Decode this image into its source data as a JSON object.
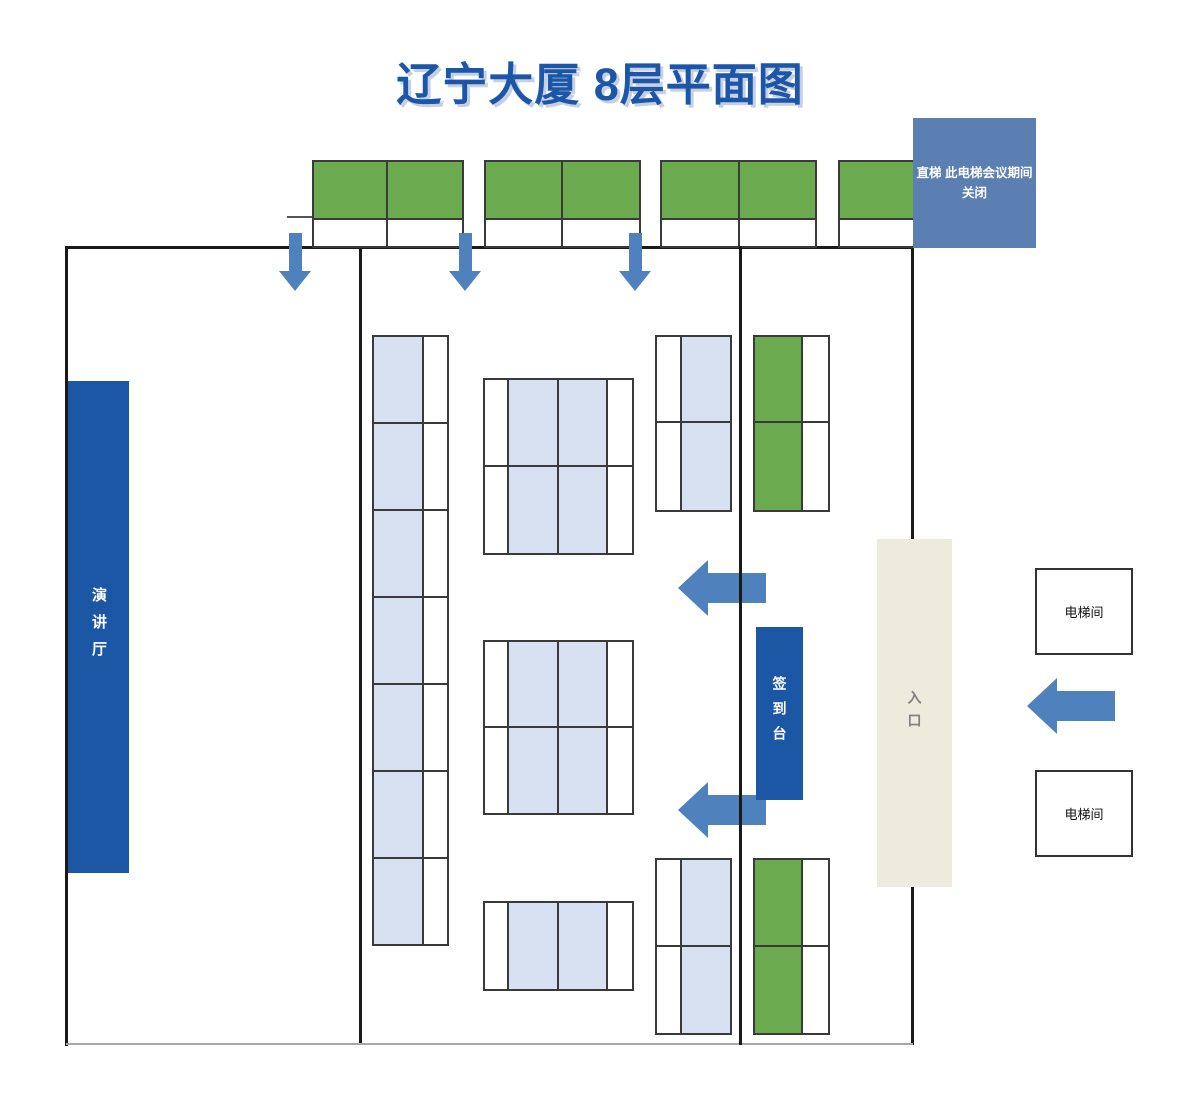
{
  "title": "辽宁大厦 8层平面图",
  "labels": {
    "lecture_hall": "演讲厅",
    "sign_in_desk": "签到台",
    "entrance": "入口",
    "elevator_room_top": "电梯间",
    "elevator_room_bottom": "电梯间",
    "elevator_note_line1": "直梯 此电梯会议期间",
    "elevator_note_line2": "关闭"
  },
  "colors": {
    "title_blue": "#1C56A8",
    "dark_blue": "#1B57A5",
    "note_blue": "#5C7FB2",
    "arrow_blue": "#4F81BD",
    "table_light_blue": "#D7E1F2",
    "furniture_green": "#6BAA4F",
    "entrance_beige": "#EDEBDC"
  }
}
